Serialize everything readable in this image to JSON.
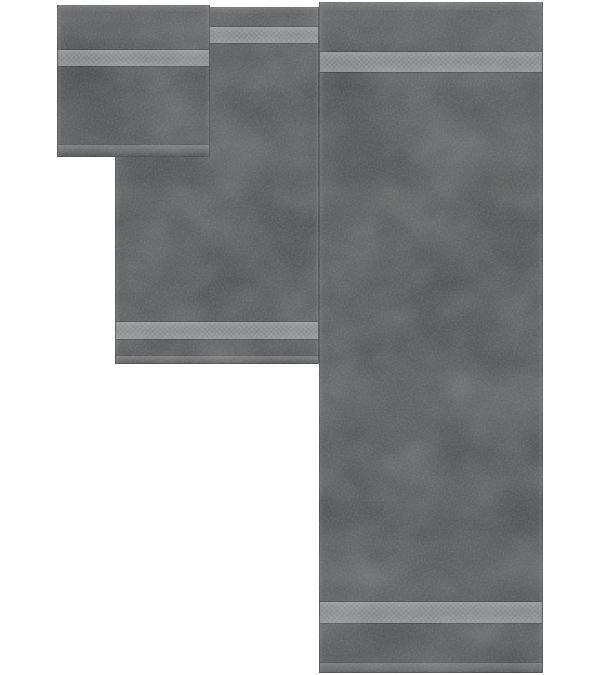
{
  "scene": {
    "type": "product-photo",
    "description": "Three-piece dark gray terry towel set arranged on a white background",
    "background_color": "#ffffff",
    "towel_color_name": "dark gray",
    "items": [
      {
        "id": "washcloth",
        "label": "Washcloth - small square towel, top left, one woven dobby band"
      },
      {
        "id": "hand-towel",
        "label": "Hand towel - medium towel, middle, dobby bands near top and bottom"
      },
      {
        "id": "bath-towel",
        "label": "Bath towel - large towel, right, dobby bands near top and bottom"
      }
    ],
    "colors": {
      "body": "#4a4c4e",
      "band": "#7d7f82",
      "band_edge": "#95979a",
      "hem": "#6b6d70"
    }
  }
}
